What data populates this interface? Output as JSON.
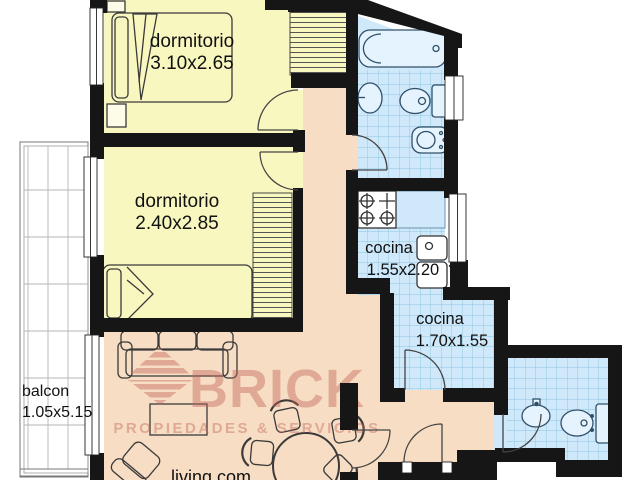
{
  "watermark": {
    "brand": "BRICK",
    "tagline": "PROPIEDADES & SERVICIOS"
  },
  "rooms": {
    "bedroom1": {
      "label": "dormitorio",
      "dimensions": "3.10x2.65"
    },
    "bedroom2": {
      "label": "dormitorio",
      "dimensions": "2.40x2.85"
    },
    "kitchen_upper": {
      "label": "cocina",
      "dimensions": "1.55x2.20"
    },
    "kitchen_lower": {
      "label": "cocina",
      "dimensions": "1.70x1.55"
    },
    "balcony": {
      "label": "balcon",
      "dimensions": "1.05x5.15"
    },
    "living": {
      "label": "living com"
    }
  },
  "colors": {
    "bedroom_fill": "#f9f7c0",
    "wet_fill": "#cfe9fa",
    "tile_line": "#8ec3e0",
    "hall_fill": "#f6ddc3",
    "fixture_fill": "#e4f3fd",
    "wall": "#161616",
    "watermark": "#c4625a"
  }
}
